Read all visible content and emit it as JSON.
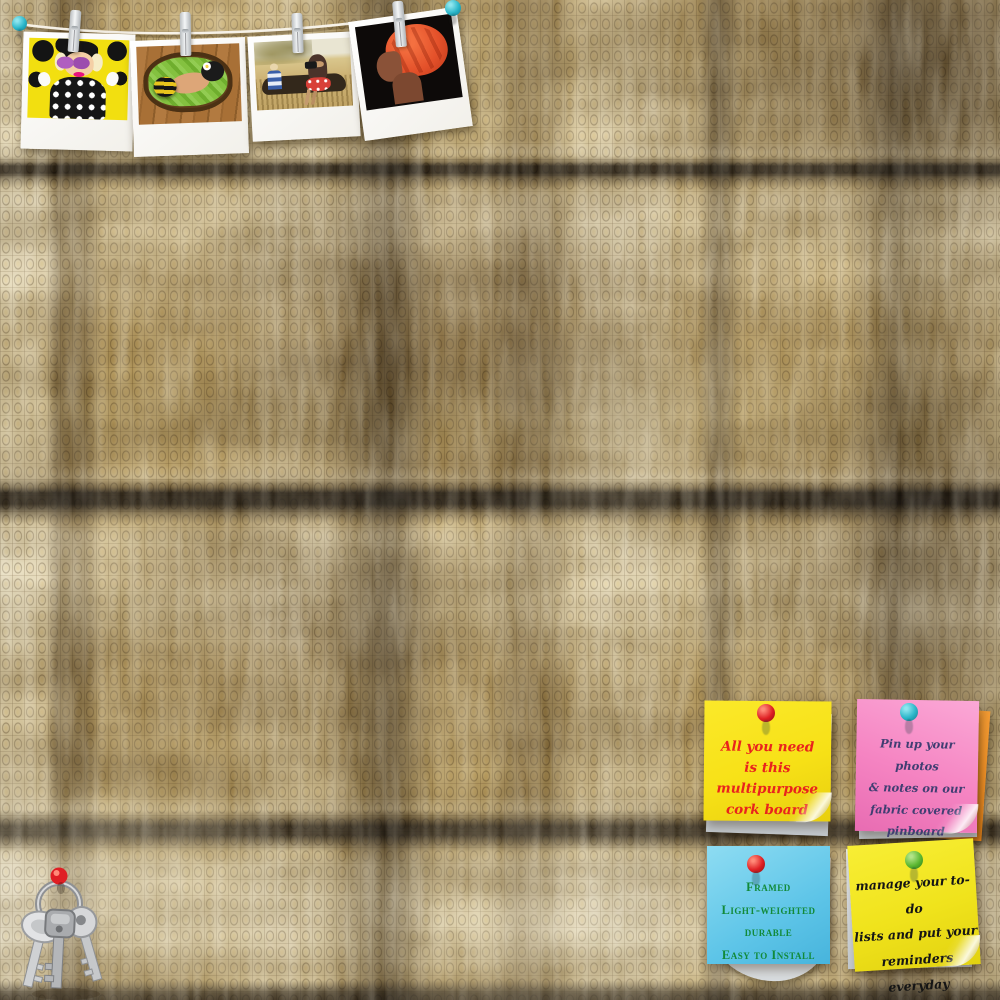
{
  "board": {
    "type_label": "fabric covered pin board",
    "fabric_base_color": "#c7ae74",
    "fabric_band_color": "#2a1d08"
  },
  "hanging_photos": {
    "string_color": "#f7f2e8",
    "clothespin_color": "#eef0f1",
    "string_pin_color": "#2ab6c9",
    "photos": [
      {
        "label": "pop-art woman with purple sunglasses on yellow background"
      },
      {
        "label": "newborn baby in bee costume on green blanket in basket"
      },
      {
        "label": "woman with camera seated outdoors with child"
      },
      {
        "label": "woman in profile wearing orange head wrap"
      }
    ]
  },
  "notes": [
    {
      "position": "top-left",
      "paper_color": "#f7e117",
      "pin_color": "#df2024",
      "text_color": "#e9231d",
      "lines": [
        "All you need",
        "is this multipurpose",
        "cork board"
      ]
    },
    {
      "position": "top-right",
      "paper_color": "#f584c2",
      "pin_color": "#2ab6c9",
      "text_color": "#403e72",
      "lines": [
        "Pin up your photos",
        "& notes on our",
        "fabric covered pinboard"
      ]
    },
    {
      "position": "bottom-left",
      "paper_color": "#5ec5e8",
      "pin_color": "#df2024",
      "text_color": "#128a3a",
      "lines": [
        "Framed",
        "Light-weighted",
        "durable",
        "Easy to Install"
      ]
    },
    {
      "position": "bottom-right",
      "paper_color": "#f0e31c",
      "pin_color": "#5cb832",
      "text_color": "#151515",
      "lines": [
        "manage your to-do",
        "lists and put your",
        "reminders everyday"
      ]
    }
  ],
  "keys": {
    "label": "key ring with three keys",
    "pin_color": "#df1f24",
    "metal_color": "#c9cbcd"
  }
}
